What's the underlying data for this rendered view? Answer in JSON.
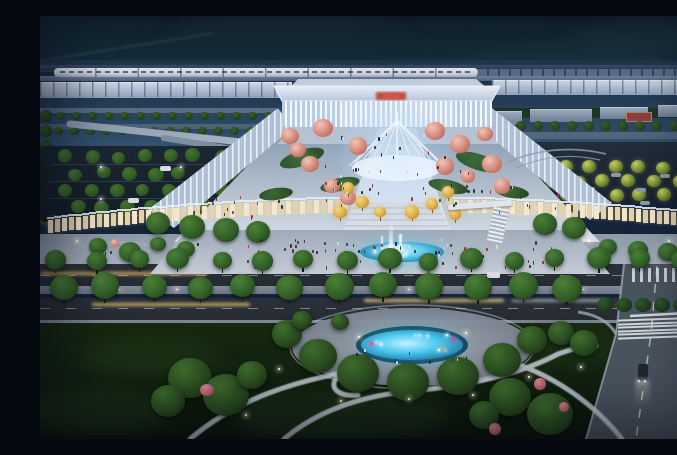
{
  "meta": {
    "description": "Night-time aerial architectural rendering of a modern high-speed railway station: illuminated glass terminal with fan-shaped entrance canopy and red station sign, terraced plaza with pink blossom trees and golden-lit trees, central fountain axis, warm-lit retail arcade podium, elevated rail viaduct with a white train, flanking parking lots, a tree-lined boulevard with light trails, a signalized intersection with zebra crosswalks, and a foreground park with a glowing cyan pond ringed by trees and curved white paths",
    "scene_type": "architectural-rendering",
    "time_of_day": "night",
    "view": "aerial-oblique"
  },
  "palette": {
    "sky_top": "#141f31",
    "sky_mid": "#1a2b41",
    "sky_low": "#2c4a66",
    "sky_horizon": "#3d5c78",
    "forest": "#1c3a42",
    "hill_band": "#2e4660",
    "viaduct": "#6e82a0",
    "platform_canopy": "#cfdceb",
    "train_body": "#f6fafd",
    "train_window": "#46586f",
    "station_roof": "#dfe8f3",
    "facade_stripe": "#b9cde8",
    "facade_bright": "#f6fbff",
    "sign_red": "#c23a2c",
    "canopy_white": "#f2f7fd",
    "plaza_light": "#d9dfe6",
    "plaza_dark": "#8598ad",
    "lawn_green": "#356329",
    "tree_green": "#2e5a26",
    "tree_green_dark": "#27431f",
    "tree_highlight": "#4c8038",
    "blossom_pink": "#f2c4b4",
    "blossom_base": "#cc7f72",
    "golden_tree": "#d9a83f",
    "golden_hi": "#f2d98a",
    "retail_warm": "#f6e7c6",
    "retail_warm2": "#e8d2a4",
    "fountain_cyan": "#5cc9ea",
    "pond_cyan": "#4cc9ef",
    "pond_deep": "#1a6e9b",
    "pond_magenta": "#e356a2",
    "pond_orange": "#e8a85c",
    "road_dark": "#262b33",
    "sidewalk": "#97a2b0",
    "median": "#79828f",
    "lane_mark": "#cfd6dd",
    "cross_road": "#4a545f",
    "zebra_white": "#e8edf2",
    "path_light": "#c6cfd8",
    "park_lawn": "#122310",
    "light_trail_warm": "#eac464",
    "light_trail_pale": "#f2dc9a",
    "parking_ground": "#1b2732",
    "parking_tree_lit": "#6d8030",
    "parking_tree_glow": "#c2d05e",
    "car_light": "#d6dce2",
    "car_dark": "#20262e",
    "building_top": "#9aa9bd",
    "red_court": "#8b4040"
  },
  "people": {
    "colors": [
      "#1f2734",
      "#35304a",
      "#4a3850",
      "#d8dde6",
      "#a23048",
      "#233824"
    ],
    "clusters": [
      {
        "name": "canopy-steps",
        "x": 300,
        "y": 116,
        "w": 112,
        "h": 26,
        "n": 14
      },
      {
        "name": "upper-plaza",
        "x": 284,
        "y": 148,
        "w": 150,
        "h": 40,
        "n": 38
      },
      {
        "name": "left-terrace",
        "x": 160,
        "y": 176,
        "w": 84,
        "h": 28,
        "n": 12
      },
      {
        "name": "right-terrace",
        "x": 436,
        "y": 170,
        "w": 86,
        "h": 28,
        "n": 12
      },
      {
        "name": "forecourt",
        "x": 205,
        "y": 222,
        "w": 310,
        "h": 30,
        "n": 46
      },
      {
        "name": "sidewalk",
        "x": 40,
        "y": 226,
        "w": 600,
        "h": 12,
        "n": 20
      },
      {
        "name": "pond-plaza",
        "x": 306,
        "y": 330,
        "w": 130,
        "h": 16,
        "n": 10
      }
    ]
  }
}
